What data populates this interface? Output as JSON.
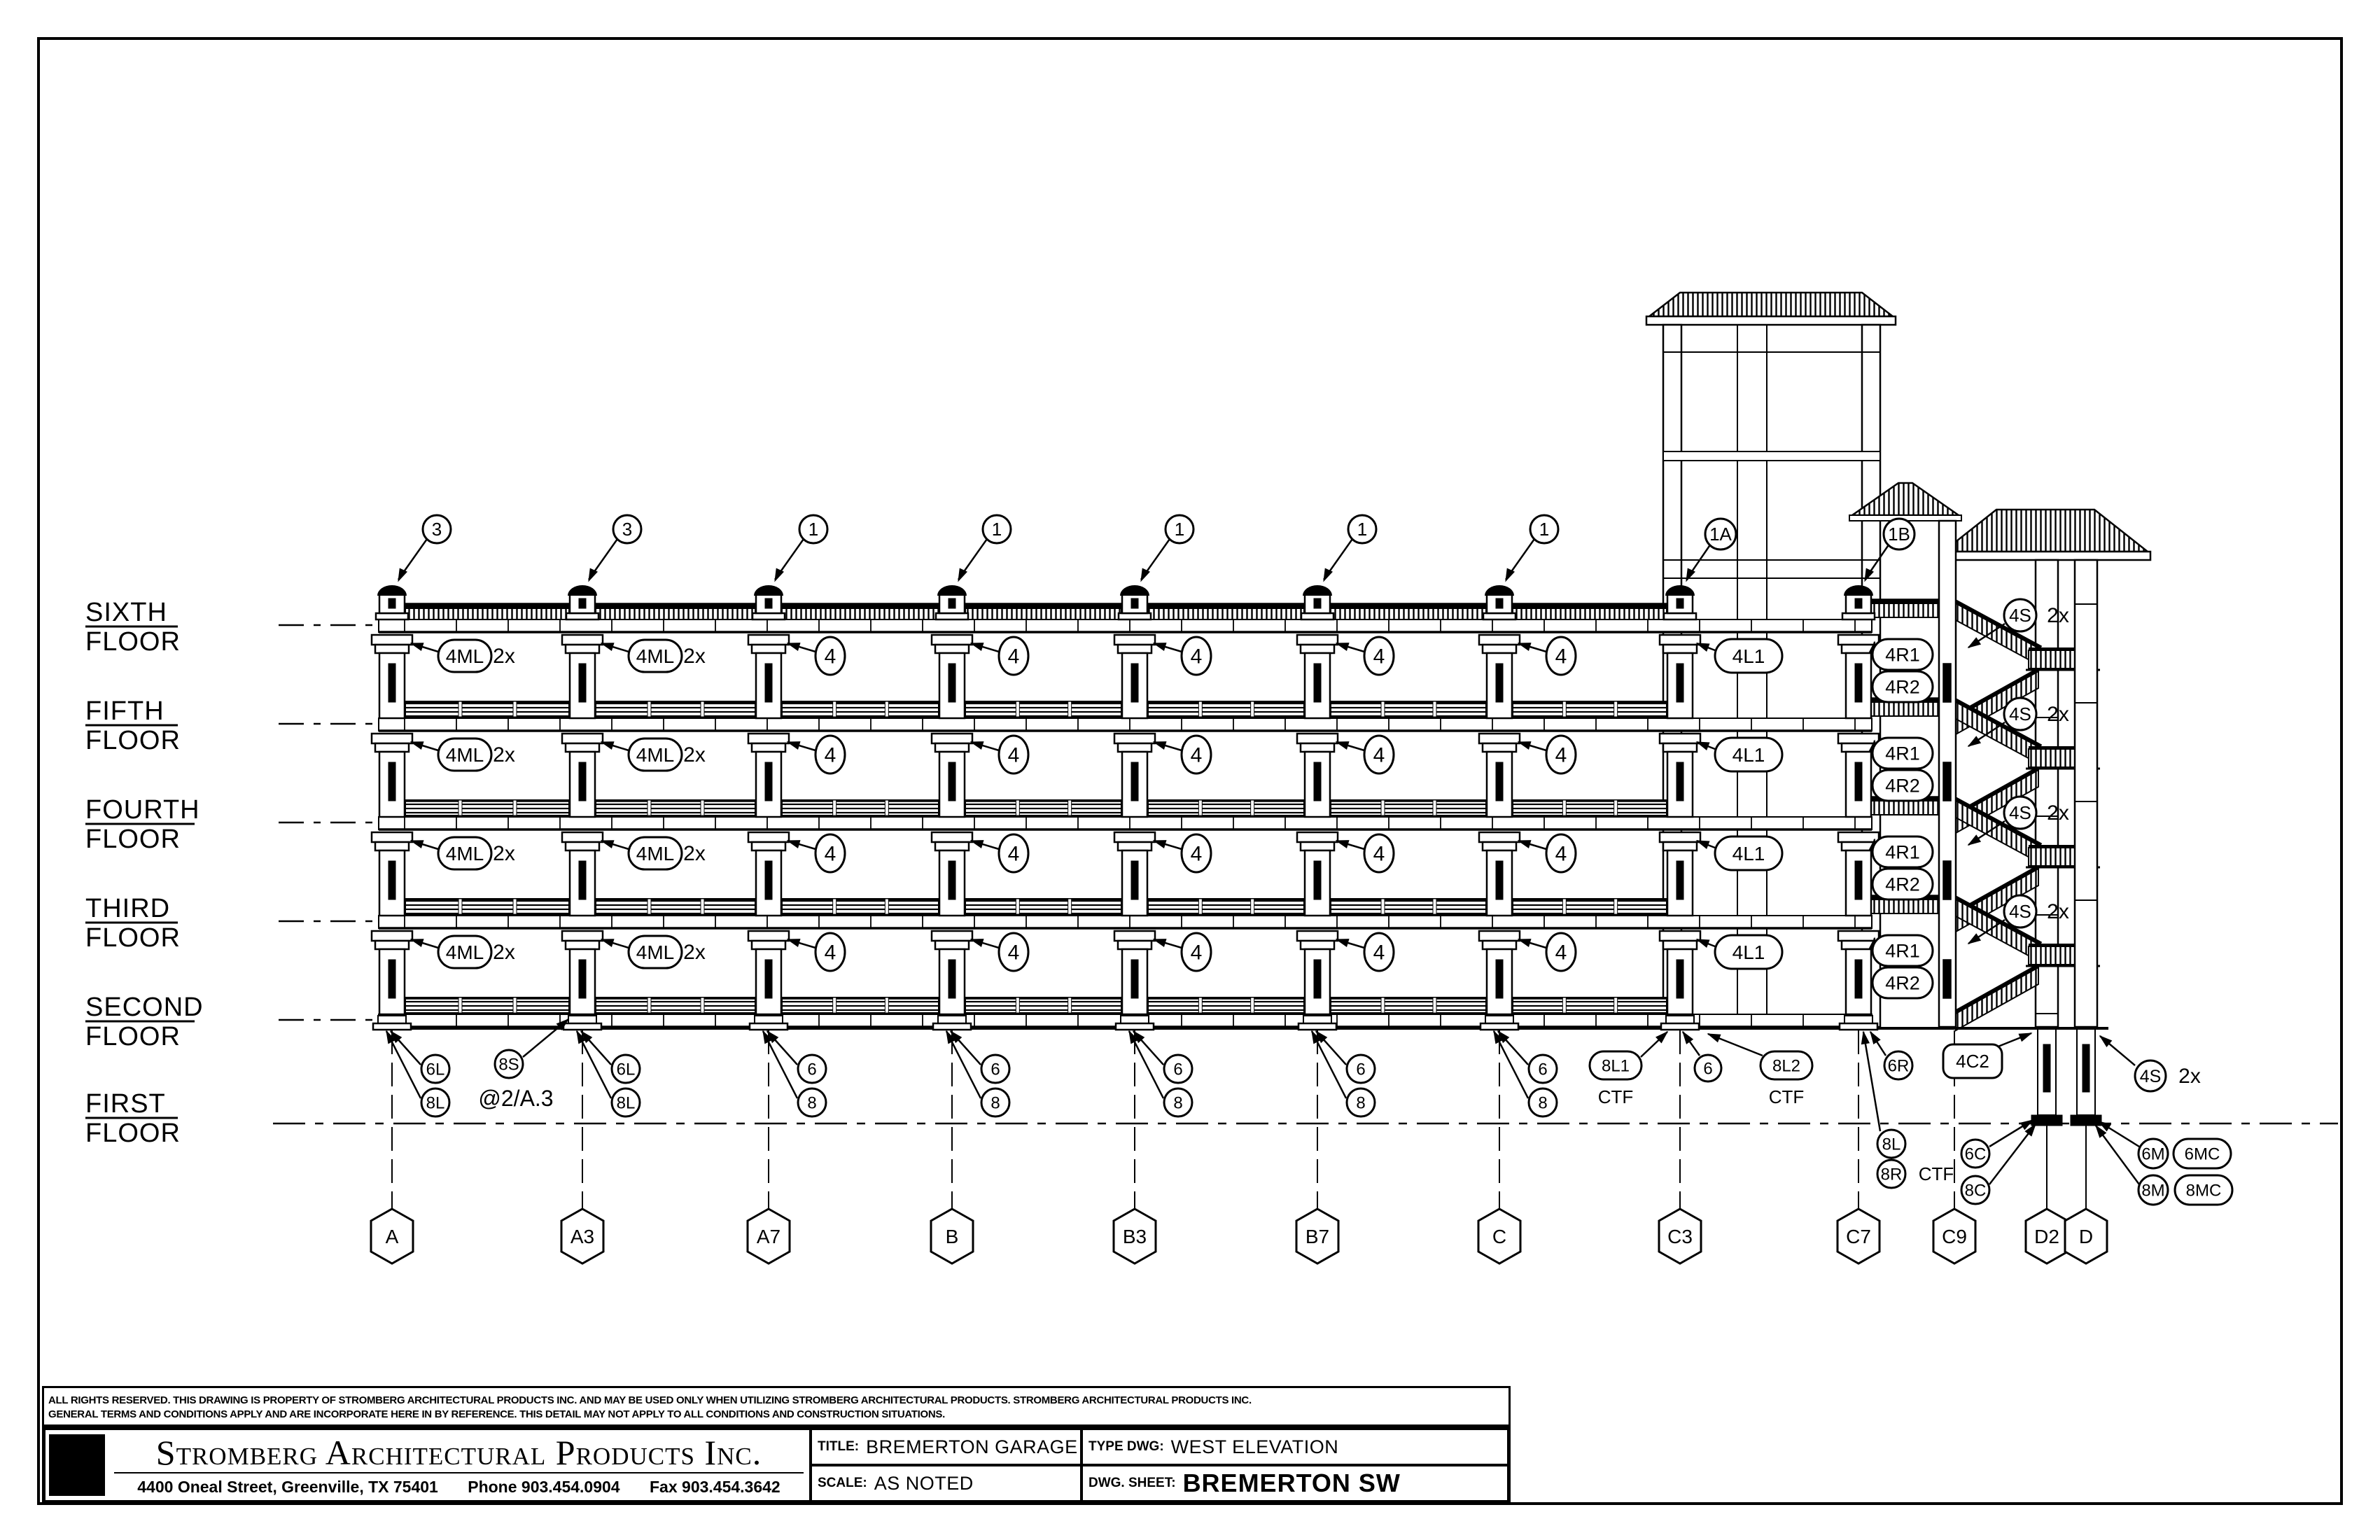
{
  "sheet": {
    "disclaimer_line1": "ALL RIGHTS RESERVED. THIS DRAWING IS PROPERTY OF STROMBERG ARCHITECTURAL PRODUCTS INC. AND MAY BE USED ONLY WHEN UTILIZING STROMBERG ARCHITECTURAL PRODUCTS.  STROMBERG ARCHITECTURAL PRODUCTS INC.",
    "disclaimer_line2": "GENERAL TERMS AND CONDITIONS APPLY AND ARE INCORPORATE HERE IN BY REFERENCE.  THIS DETAIL MAY NOT APPLY TO ALL CONDITIONS AND CONSTRUCTION SITUATIONS.",
    "company": "Stromberg Architectural Products Inc.",
    "address": "4400 Oneal Street, Greenville, TX  75401",
    "phone": "Phone 903.454.0904",
    "fax": "Fax 903.454.3642",
    "title_label": "TITLE:",
    "title_value": "BREMERTON GARAGE",
    "type_label": "TYPE DWG:",
    "type_value": "WEST ELEVATION",
    "scale_label": "SCALE:",
    "scale_value": "AS NOTED",
    "sheet_label": "DWG. SHEET:",
    "sheet_value": "BREMERTON SW"
  },
  "floor_labels": [
    {
      "word1": "SIXTH",
      "word2": "FLOOR"
    },
    {
      "word1": "FIFTH",
      "word2": "FLOOR"
    },
    {
      "word1": "FOURTH",
      "word2": "FLOOR"
    },
    {
      "word1": "THIRD",
      "word2": "FLOOR"
    },
    {
      "word1": "SECOND",
      "word2": "FLOOR"
    },
    {
      "word1": "FIRST",
      "word2": "FLOOR"
    }
  ],
  "grid_labels": [
    "A",
    "A3",
    "A7",
    "B",
    "B3",
    "B7",
    "C",
    "C3",
    "C7",
    "C9",
    "D2",
    "D"
  ],
  "top_markers": [
    "3",
    "3",
    "1",
    "1",
    "1",
    "1",
    "1",
    "1A",
    "1B"
  ],
  "story_markers": {
    "ml_label": "4ML",
    "ml_suffix": "2x",
    "plain": "4",
    "tower": "4L1",
    "right1": "4R1",
    "right2": "4R2",
    "stair_label": "4S",
    "stair_suffix": "2x"
  },
  "base_markers": {
    "col_pairs": [
      [
        "6L",
        "8L"
      ],
      [
        "6L",
        "8L"
      ],
      [
        "6",
        "8"
      ],
      [
        "6",
        "8"
      ],
      [
        "6",
        "8"
      ],
      [
        "6",
        "8"
      ],
      [
        "6",
        "8"
      ]
    ],
    "splice_label": "8S",
    "splice_note": "@2/A.3",
    "c3_left_label": "8L1",
    "c3_left_sub": "CTF",
    "c3_mid": "6",
    "c3_right_label": "8L2",
    "c3_right_sub": "CTF",
    "c7_top": "6R",
    "c7_below1": "8L",
    "c7_below2": "8R",
    "c7_below_sub": "CTF",
    "corner": "4C2",
    "left_pad": [
      "6C",
      "8C"
    ],
    "right_pad_circles": [
      "6M",
      "8M"
    ],
    "right_pad_stadiums": [
      "6MC",
      "8MC"
    ],
    "ground_stair_label": "4S",
    "ground_stair_suffix": "2x"
  }
}
